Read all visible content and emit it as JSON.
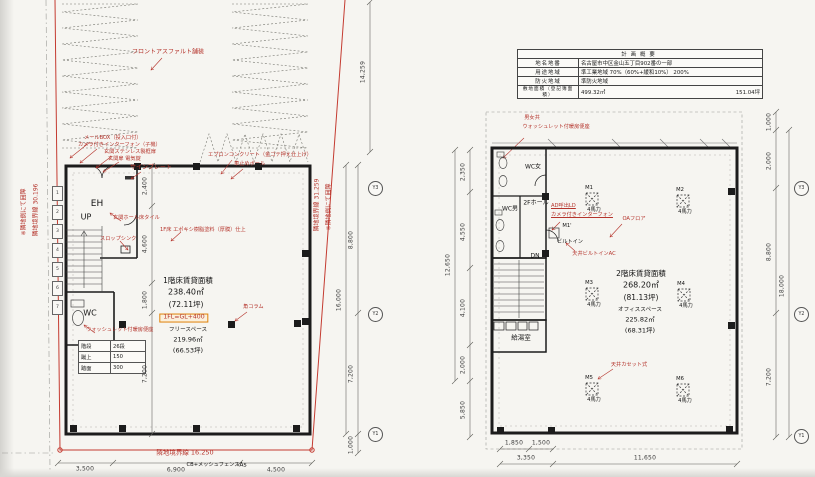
{
  "colors": {
    "annotation_red": "#b5342c",
    "wall_black": "#1c1c1c",
    "dim_gray": "#3c3c3c",
    "level_box_orange": "#e0820a"
  },
  "overview_table": {
    "title": "計画概要",
    "rows": [
      {
        "label": "地名地番",
        "value": "名古屋市中区金山五丁目902番の一部"
      },
      {
        "label": "用途地域",
        "value": "準工業地域 70%（60%+緩和10%） 200%"
      },
      {
        "label": "防火地域",
        "value": "準防火地域"
      },
      {
        "label": "敷地面積（登記簿面積）",
        "value": "499.32㎡",
        "value2": "151.04坪"
      }
    ]
  },
  "site": {
    "paving_label": "フロントアスファルト舗装",
    "boundary_left": "隣地境界線 30.196",
    "boundary_left_note": "※隣地側にて囲障",
    "boundary_right": "隣地境界線 31.259",
    "boundary_right_note": "※隣地側にて囲障",
    "boundary_bottom": "隣地境界線 16.250",
    "fence_note": "CB+メッシュフェンス",
    "paving_code": "As",
    "stall_numbers": [
      "1",
      "2",
      "3",
      "4",
      "5",
      "6",
      "7"
    ]
  },
  "floor1": {
    "rooms": {
      "eh": "EH",
      "up": "UP",
      "wc": "WC"
    },
    "annotations": {
      "mail": "メールBOX（投入口付）",
      "interphone": "カメラ付きインターフォン（子機）",
      "entrance_door": "玄関ステンレス製框扉",
      "lock": "玄関扉 電気錠",
      "sign": "サインプレート",
      "apron": "エプロンコンクリート（金ゴテ押え仕上げ）",
      "pole": "車止めポール",
      "hall_tile": "玄関ホール床タイル",
      "slop_sink": "スロップシンク",
      "floor_finish": "1F床 エポキシ樹脂塗料（厚膜）仕上",
      "column": "角コラム",
      "washlet": "ウォッシュレット付暖房便座"
    },
    "area": {
      "title": "1階床賃貸面積",
      "m2": "238.40㎡",
      "tsubo": "(72.11坪)",
      "level": "1FL=GL+400",
      "free_label": "フリースペース",
      "free_m2": "219.96㎡",
      "free_tsubo": "(66.53坪)"
    },
    "stair_table": {
      "rows": [
        [
          "階段",
          "26段"
        ],
        [
          "蹴上",
          "150"
        ],
        [
          "踏面",
          "300"
        ]
      ]
    }
  },
  "floor2": {
    "rooms": {
      "wc_w": "WC女",
      "wc_m": "WC男",
      "hall": "2Fホール",
      "kitchen": "給湯室",
      "dn": "DN"
    },
    "annotations": {
      "wc_shared": "男女共",
      "washlet": "ウォッシュレット付暖房便座",
      "call": "AD呼出LD",
      "interphone": "カメラ付きインターフォン",
      "oa_floor": "OAフロア",
      "builtin_ac": "天井ビルトインAC",
      "builtin_label": "ビルトイン",
      "m1_dash": "M1'",
      "cassette_ac": "天井カセット式"
    },
    "area": {
      "title": "2階床賃貸面積",
      "m2": "268.20㎡",
      "tsubo": "(81.13坪)",
      "office_label": "オフィススペース",
      "office_m2": "225.82㎡",
      "office_tsubo": "(68.31坪)"
    },
    "ac_units": [
      {
        "id": "M1",
        "power": "4馬力"
      },
      {
        "id": "M2",
        "power": "4馬力"
      },
      {
        "id": "M3",
        "power": "4馬力"
      },
      {
        "id": "M4",
        "power": "4馬力"
      },
      {
        "id": "M5",
        "power": "4馬力"
      },
      {
        "id": "M6",
        "power": "4馬力"
      }
    ]
  },
  "dims": {
    "f1_right": {
      "d14259": "14,259",
      "d8800": "8,800",
      "d16000": "16,000",
      "d7200": "7,200",
      "d1000": "1,000"
    },
    "f1_bottom": {
      "d3500": "3,500",
      "d6900": "6,900",
      "d4500": "4,500"
    },
    "f1_interior": {
      "d2400": "2,400",
      "d4600": "4,600",
      "d1800": "1,800",
      "d7200": "7,200"
    },
    "f2_left": {
      "d2350": "2,350",
      "d4550": "4,550",
      "d12650": "12,650",
      "d4100": "4,100",
      "d2000": "2,000",
      "d5850": "5,850"
    },
    "f2_right": {
      "d1000": "1,000",
      "d2000": "2,000",
      "d8800": "8,800",
      "d18000": "18,000",
      "d7200": "7,200"
    },
    "f2_bottom": {
      "d1850": "1,850",
      "d1500": "1,500",
      "d3350": "3,350",
      "d11650": "11,650"
    }
  },
  "grid": {
    "bubbles": [
      "Y3",
      "Y2",
      "Y1"
    ]
  }
}
